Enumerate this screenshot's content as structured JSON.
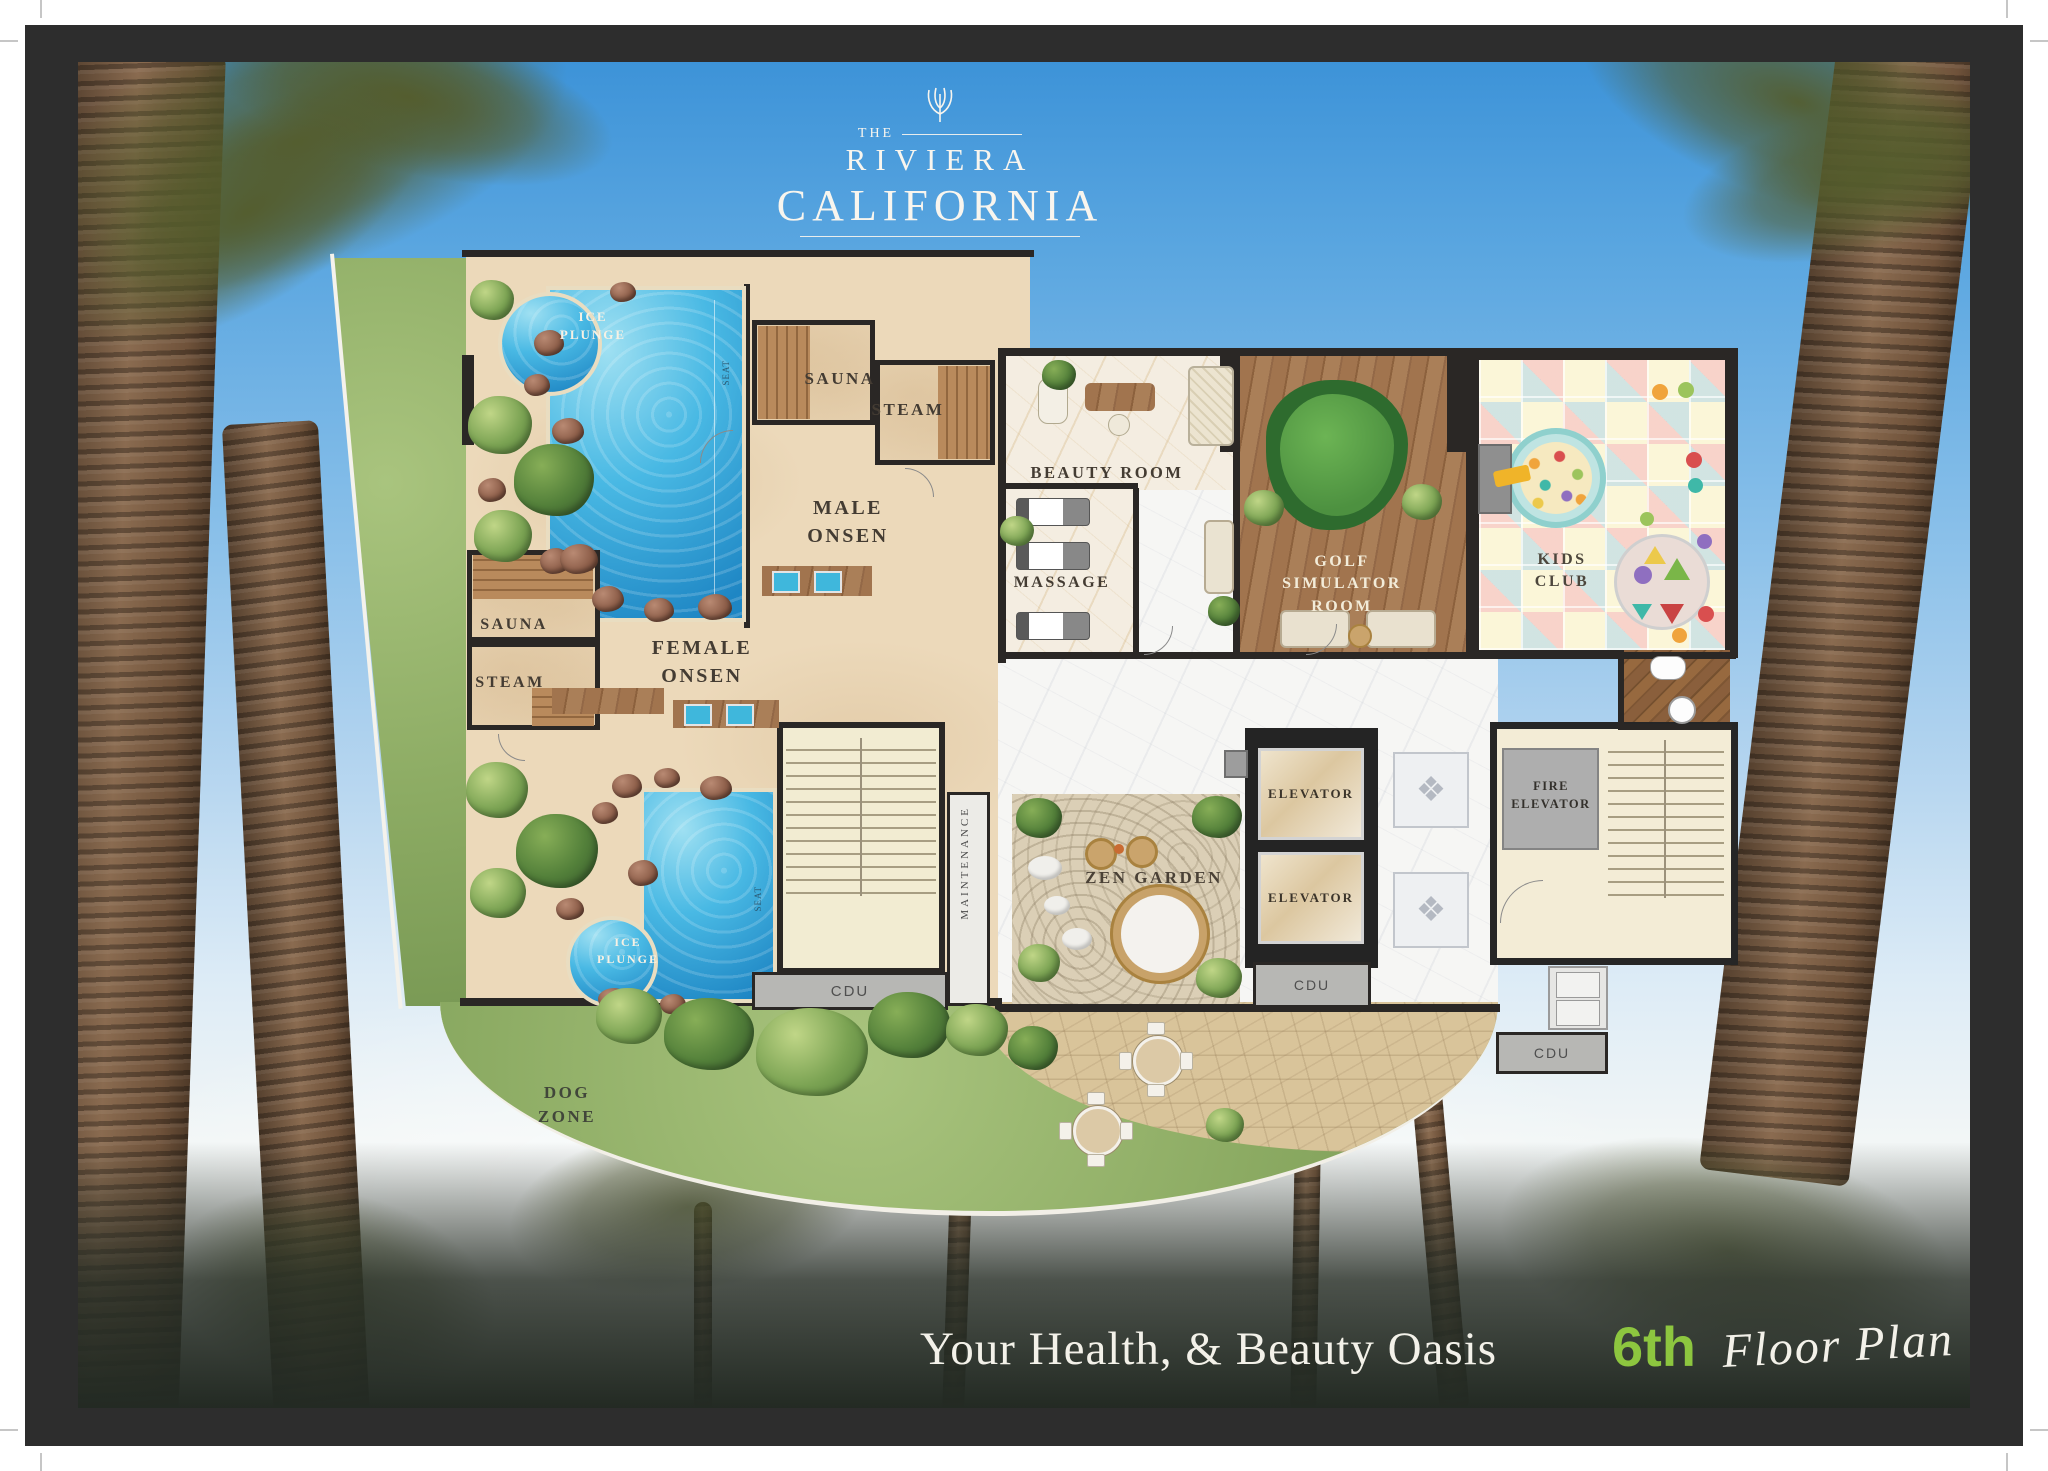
{
  "logo": {
    "the": "THE",
    "name": "RIVIERA",
    "location": "CALIFORNIA"
  },
  "footer": {
    "tagline": "Your Health, & Beauty Oasis",
    "floor_number": "6th",
    "floor_plan_label": "Floor Plan",
    "accent_color": "#8dc63f"
  },
  "labels": {
    "ice_plunge": "ICE\nPLUNGE",
    "sauna": "SAUNA",
    "steam": "STEAM",
    "male_onsen": "MALE\nONSEN",
    "female_onsen": "FEMALE\nONSEN",
    "beauty_room": "BEAUTY ROOM",
    "massage": "MASSAGE",
    "golf_simulator": "GOLF SIMULATOR\nROOM",
    "kids_club": "KIDS\nCLUB",
    "zen_garden": "ZEN GARDEN",
    "elevator": "ELEVATOR",
    "fire_elevator": "FIRE\nELEVATOR",
    "maintenance": "MAINTENANCE",
    "cdu": "CDU",
    "dog_zone": "DOG\nZONE",
    "seat": "SEAT"
  },
  "colors": {
    "wall": "#2a2725",
    "pool_water": "#2a9fd8",
    "sand_floor": "#ecd9ba",
    "lawn": "#8cab63",
    "marble": "#f6f6f4",
    "wood": "#9a6f4b",
    "accent_green": "#8dc63f"
  },
  "icons": {
    "logo_ornament": "palmette-flourish",
    "medallion": "❖"
  }
}
